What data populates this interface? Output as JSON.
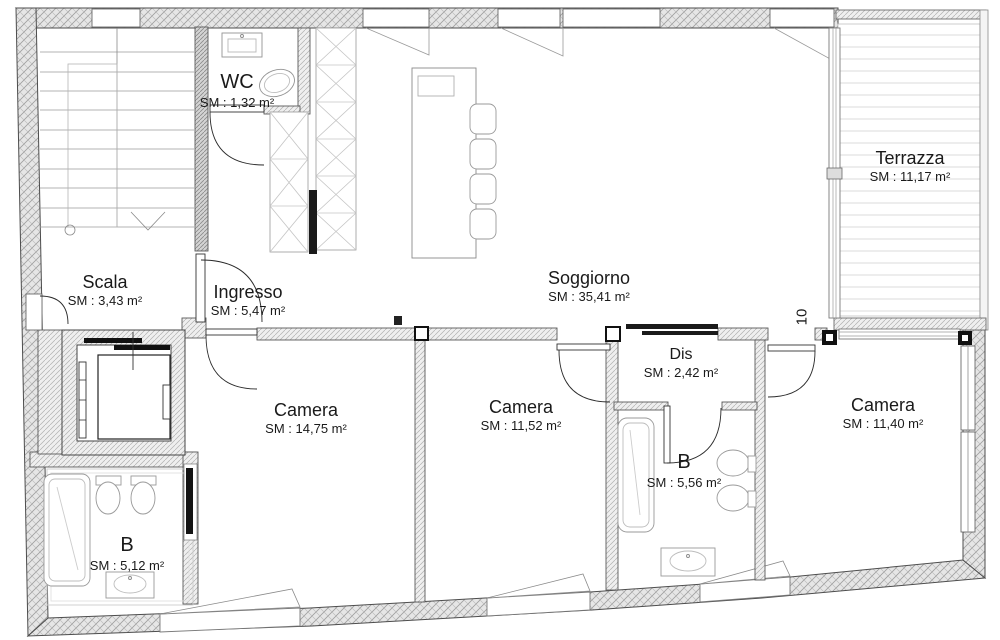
{
  "plan": {
    "rooms": {
      "wc": {
        "name": "WC",
        "area": "SM : 1,32 m²"
      },
      "terrazza": {
        "name": "Terrazza",
        "area": "SM : 11,17 m²"
      },
      "scala": {
        "name": "Scala",
        "area": "SM : 3,43 m²"
      },
      "ingresso": {
        "name": "Ingresso",
        "area": "SM : 5,47 m²"
      },
      "soggiorno": {
        "name": "Soggiorno",
        "area": "SM : 35,41 m²"
      },
      "dis": {
        "name": "Dis",
        "area": "SM : 2,42 m²"
      },
      "camera_1": {
        "name": "Camera",
        "area": "SM : 14,75 m²"
      },
      "camera_2": {
        "name": "Camera",
        "area": "SM : 11,52 m²"
      },
      "camera_3": {
        "name": "Camera",
        "area": "SM : 11,40 m²"
      },
      "bagno_1": {
        "name": "B",
        "area": "SM : 5,56 m²"
      },
      "bagno_2": {
        "name": "B",
        "area": "SM : 5,12 m²"
      }
    },
    "annotations": {
      "dimension_label": "10"
    },
    "colors": {
      "background": "#ffffff",
      "wall_line": "#4d4d4d",
      "wall_fill": "#e8e8e8",
      "fixture_line": "#949494",
      "door_leaf": "#1a1a1a",
      "text": "#1a1a1a"
    }
  }
}
